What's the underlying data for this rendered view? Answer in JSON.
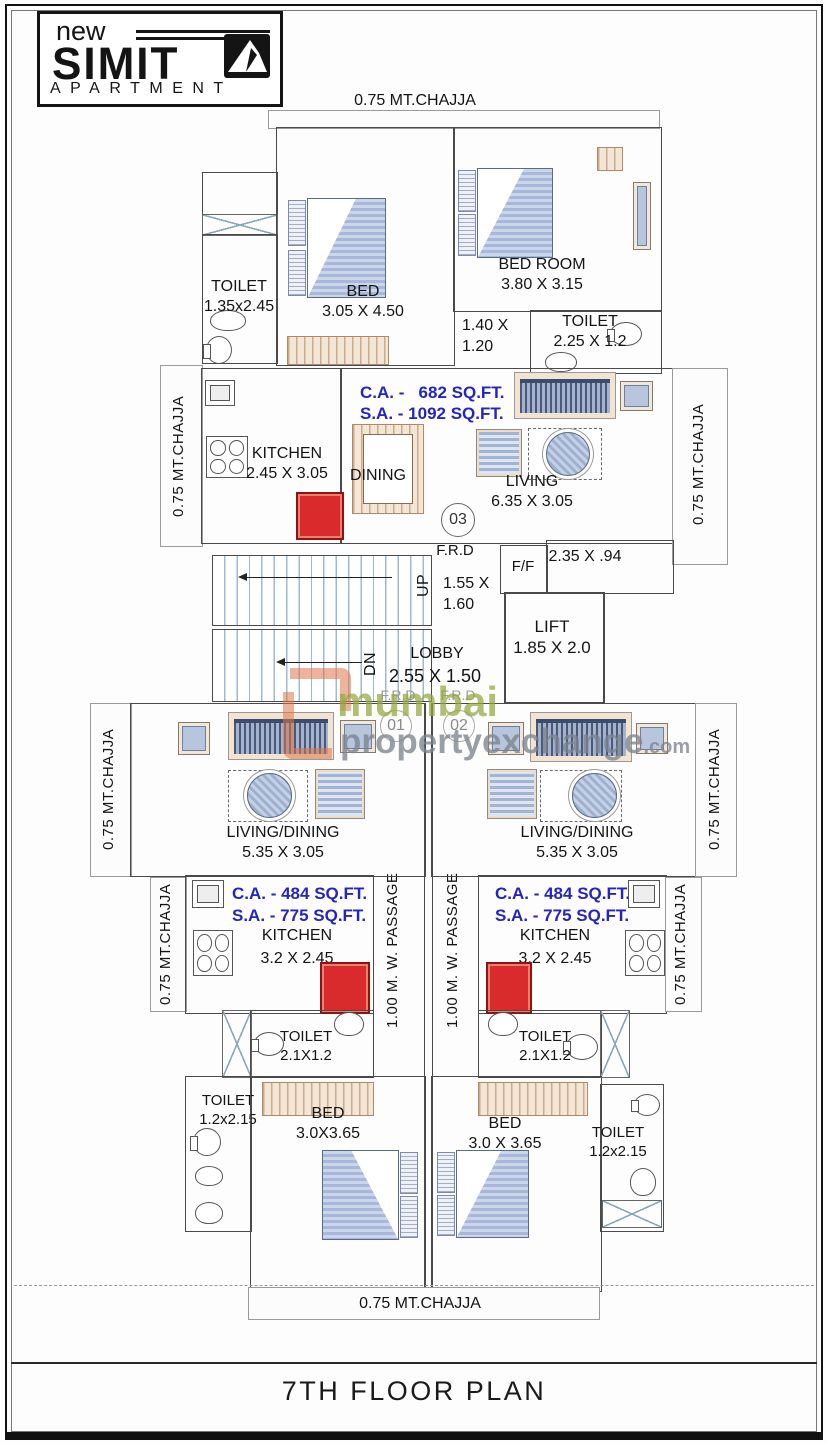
{
  "logo": {
    "prefix": "new",
    "name": "SIMIT",
    "sub": "APARTMENT"
  },
  "chajja": {
    "top": "0.75 MT.CHAJJA",
    "bottom": "0.75 MT.CHAJJA",
    "u3_left": "0.75 MT.CHAJJA",
    "u3_right": "0.75 MT.CHAJJA",
    "u1_living": "0.75 MT.CHAJJA",
    "u1_kitchen": "0.75 MT.CHAJJA",
    "u2_living": "0.75 MT.CHAJJA",
    "u2_kitchen": "0.75 MT.CHAJJA"
  },
  "unit3": {
    "number": "03",
    "toilet_left": {
      "name": "TOILET",
      "dim": "1.35x2.45"
    },
    "bed": {
      "name": "BED",
      "dim": "3.05 X 4.50"
    },
    "bedroom": {
      "name": "BED ROOM",
      "dim": "3.80 X 3.15"
    },
    "toilet_right": {
      "name": "TOILET",
      "dim": "2.25 X 1.2"
    },
    "entry_dim": {
      "l1": "1.40 X",
      "l2": "1.20"
    },
    "ca": "C.A. -   682 SQ.FT.",
    "sa": "S.A. - 1092 SQ.FT.",
    "kitchen": {
      "name": "KITCHEN",
      "dim": "2.45 X 3.05"
    },
    "dining": "DINING",
    "living": {
      "name": "LIVING",
      "dim": "6.35 X 3.05"
    },
    "frd": "F.R.D"
  },
  "core": {
    "up": "UP",
    "dn": "DN",
    "stair_dim": {
      "l1": "1.55 X",
      "l2": "1.60"
    },
    "ff": "F/F",
    "terrace_dim": "2.35 X .94",
    "lift": {
      "name": "LIFT",
      "dim": "1.85 X 2.0"
    },
    "lobby": {
      "name": "LOBBY",
      "dim": "2.55 X 1.50"
    },
    "frd_left": "F.R.D",
    "frd_right": "F.R.D",
    "door1": "01",
    "door2": "02"
  },
  "watermark": {
    "word1": "mumbai",
    "word2": "propertyexchange",
    "word3": ".com"
  },
  "unit1": {
    "living": {
      "name": "LIVING/DINING",
      "dim": "5.35 X 3.05"
    },
    "ca": "C.A. - 484 SQ.FT.",
    "sa": "S.A. - 775 SQ.FT.",
    "kitchen": {
      "name": "KITCHEN",
      "dim": "3.2 X 2.45"
    },
    "passage": "1.00 M. W. PASSAGE",
    "toilet_small": {
      "name": "TOILET",
      "dim": "2.1X1.2"
    },
    "toilet_big": {
      "name": "TOILET",
      "dim": "1.2x2.15"
    },
    "bed": {
      "name": "BED",
      "dim": "3.0X3.65"
    }
  },
  "unit2": {
    "living": {
      "name": "LIVING/DINING",
      "dim": "5.35 X 3.05"
    },
    "ca": "C.A. - 484 SQ.FT.",
    "sa": "S.A. - 775 SQ.FT.",
    "kitchen": {
      "name": "KITCHEN",
      "dim": "3.2 X 2.45"
    },
    "passage": "1.00 M. W. PASSAGE",
    "toilet_small": {
      "name": "TOILET",
      "dim": "2.1X1.2"
    },
    "toilet_big": {
      "name": "TOILET",
      "dim": "1.2x2.15"
    },
    "bed": {
      "name": "BED",
      "dim": "3.0 X 3.65"
    }
  },
  "footer": {
    "title": "7TH FLOOR PLAN"
  }
}
